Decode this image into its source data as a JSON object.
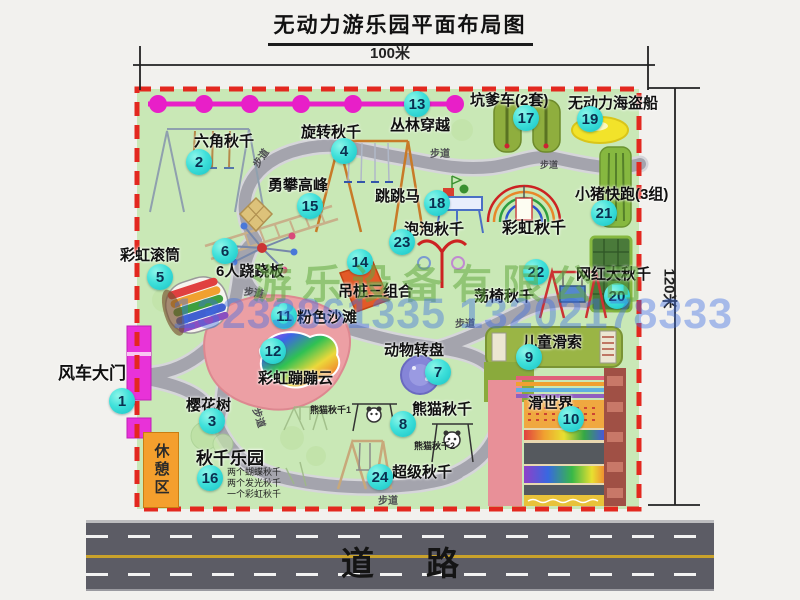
{
  "title": "无动力游乐园平面布局图",
  "dimensions": {
    "width_label": "100米",
    "height_label": "120米"
  },
  "watermark": {
    "company": "游乐设备有限公司",
    "phone": "13233861335 13202178333"
  },
  "road": {
    "label": "道路"
  },
  "extras": {
    "rest_area": "休憩区",
    "walkway": "步道",
    "rainbow_swing": "彩虹秋千",
    "panda_swing_1": "熊猫秋千1",
    "panda_swing_2": "熊猫秋千2"
  },
  "attractions": [
    {
      "n": "1",
      "label": "风车大门"
    },
    {
      "n": "2",
      "label": "六角秋千"
    },
    {
      "n": "3",
      "label": "樱花树"
    },
    {
      "n": "4",
      "label": "旋转秋千"
    },
    {
      "n": "5",
      "label": "彩虹滚筒"
    },
    {
      "n": "6",
      "label": "6人跷跷板"
    },
    {
      "n": "7",
      "label": "动物转盘"
    },
    {
      "n": "8",
      "label": "熊猫秋千"
    },
    {
      "n": "9",
      "label": "儿童滑索"
    },
    {
      "n": "10",
      "label": "滑世界"
    },
    {
      "n": "11",
      "label": "粉色沙滩"
    },
    {
      "n": "12",
      "label": "彩虹蹦蹦云"
    },
    {
      "n": "13",
      "label": "丛林穿越"
    },
    {
      "n": "14",
      "label": "吊桩三组合"
    },
    {
      "n": "15",
      "label": "勇攀高峰"
    },
    {
      "n": "16",
      "label": "秋千乐园",
      "sub": [
        "两个蝴蝶秋千",
        "两个发光秋千",
        "一个彩虹秋千"
      ]
    },
    {
      "n": "17",
      "label": "坑爹车(2套)"
    },
    {
      "n": "18",
      "label": "跳跳马"
    },
    {
      "n": "19",
      "label": "无动力海盗船"
    },
    {
      "n": "20",
      "label": "网红大秋千"
    },
    {
      "n": "21",
      "label": "小猪快跑(3组)"
    },
    {
      "n": "22",
      "label": "荡椅秋千"
    },
    {
      "n": "23",
      "label": "泡泡秋千"
    },
    {
      "n": "24",
      "label": "超级秋千"
    }
  ],
  "colors": {
    "park_green": "#c9e8b6",
    "border_red": "#e3281f",
    "zipline_magenta": "#e81fc8",
    "badge_cyan": "#2fd6d2",
    "road_gray": "#5c5c65"
  }
}
